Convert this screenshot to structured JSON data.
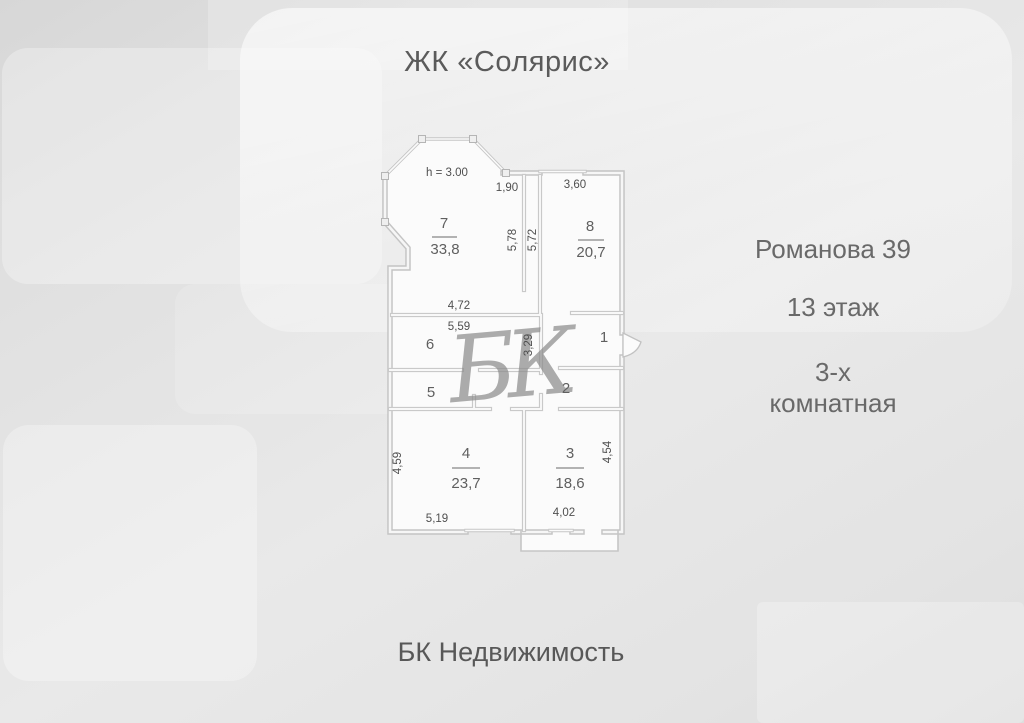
{
  "header": {
    "title": "ЖК «Солярис»"
  },
  "info": {
    "address": "Романова 39",
    "floor": "13 этаж",
    "rooms_line1": "3-х",
    "rooms_line2": "комнатная"
  },
  "footer": {
    "brand": "БК Недвижимость"
  },
  "colors": {
    "wall": "#c6c6c6",
    "text": "#5f5f5f",
    "watermark": "#8d8d8d"
  },
  "plan": {
    "ceiling_height": "h = 3.00",
    "watermark": "БК",
    "rooms": [
      {
        "number": "7",
        "area": "33,8"
      },
      {
        "number": "8",
        "area": "20,7"
      },
      {
        "number": "6",
        "area": ""
      },
      {
        "number": "5",
        "area": ""
      },
      {
        "number": "1",
        "area": ""
      },
      {
        "number": "2",
        "area": ""
      },
      {
        "number": "4",
        "area": "23,7"
      },
      {
        "number": "3",
        "area": "18,6"
      }
    ],
    "dims": {
      "top_left": "1,90",
      "top_right": "3,60",
      "hall_left": "5,78",
      "hall_right": "5,72",
      "mid_upper": "4,72",
      "mid_lower": "5,59",
      "mid_vert": "3,29",
      "room4_height": "4,59",
      "room3_height": "4,54",
      "room4_width": "5,19",
      "room3_width": "4,02"
    }
  }
}
